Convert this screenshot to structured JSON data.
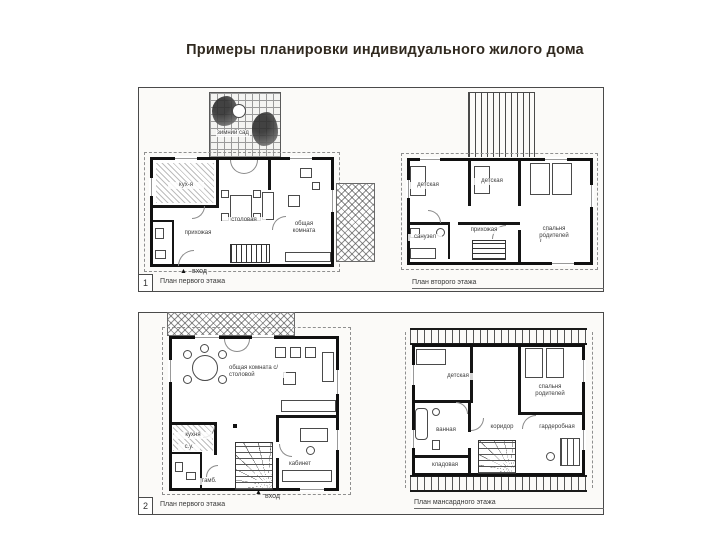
{
  "title": "Примеры планировки индивидуального жилого дома",
  "panels": {
    "p1": {
      "number": "1",
      "plan1": {
        "caption": "План первого этажа",
        "entrance": "вход",
        "entrance_arrow": "▲",
        "rooms": {
          "winter_garden": "зимний сад",
          "kitchen": "кух-я",
          "dining": "столовая",
          "living": "общая комната",
          "hall": "прихожая"
        }
      },
      "plan2": {
        "caption": "План второго этажа",
        "rooms": {
          "kids1": "детская",
          "kids2": "детская",
          "parents": "спальня родителей",
          "hall": "прихожая",
          "bath": "санузел"
        }
      }
    },
    "p2": {
      "number": "2",
      "plan3": {
        "caption": "План первого этажа",
        "entrance": "вход",
        "entrance_arrow": "▲",
        "rooms": {
          "living_dining": "общая комната с/ столовой",
          "kitchen": "кухня",
          "wc": "с.у.",
          "vestibule": "тамб.",
          "study": "кабинет"
        }
      },
      "plan4": {
        "caption": "План мансардного этажа",
        "rooms": {
          "kids": "детская",
          "parents": "спальня родителей",
          "corridor": "коридор",
          "wardrobe": "гардеробная",
          "bath": "ванная",
          "storage": "кладовая"
        }
      }
    }
  }
}
